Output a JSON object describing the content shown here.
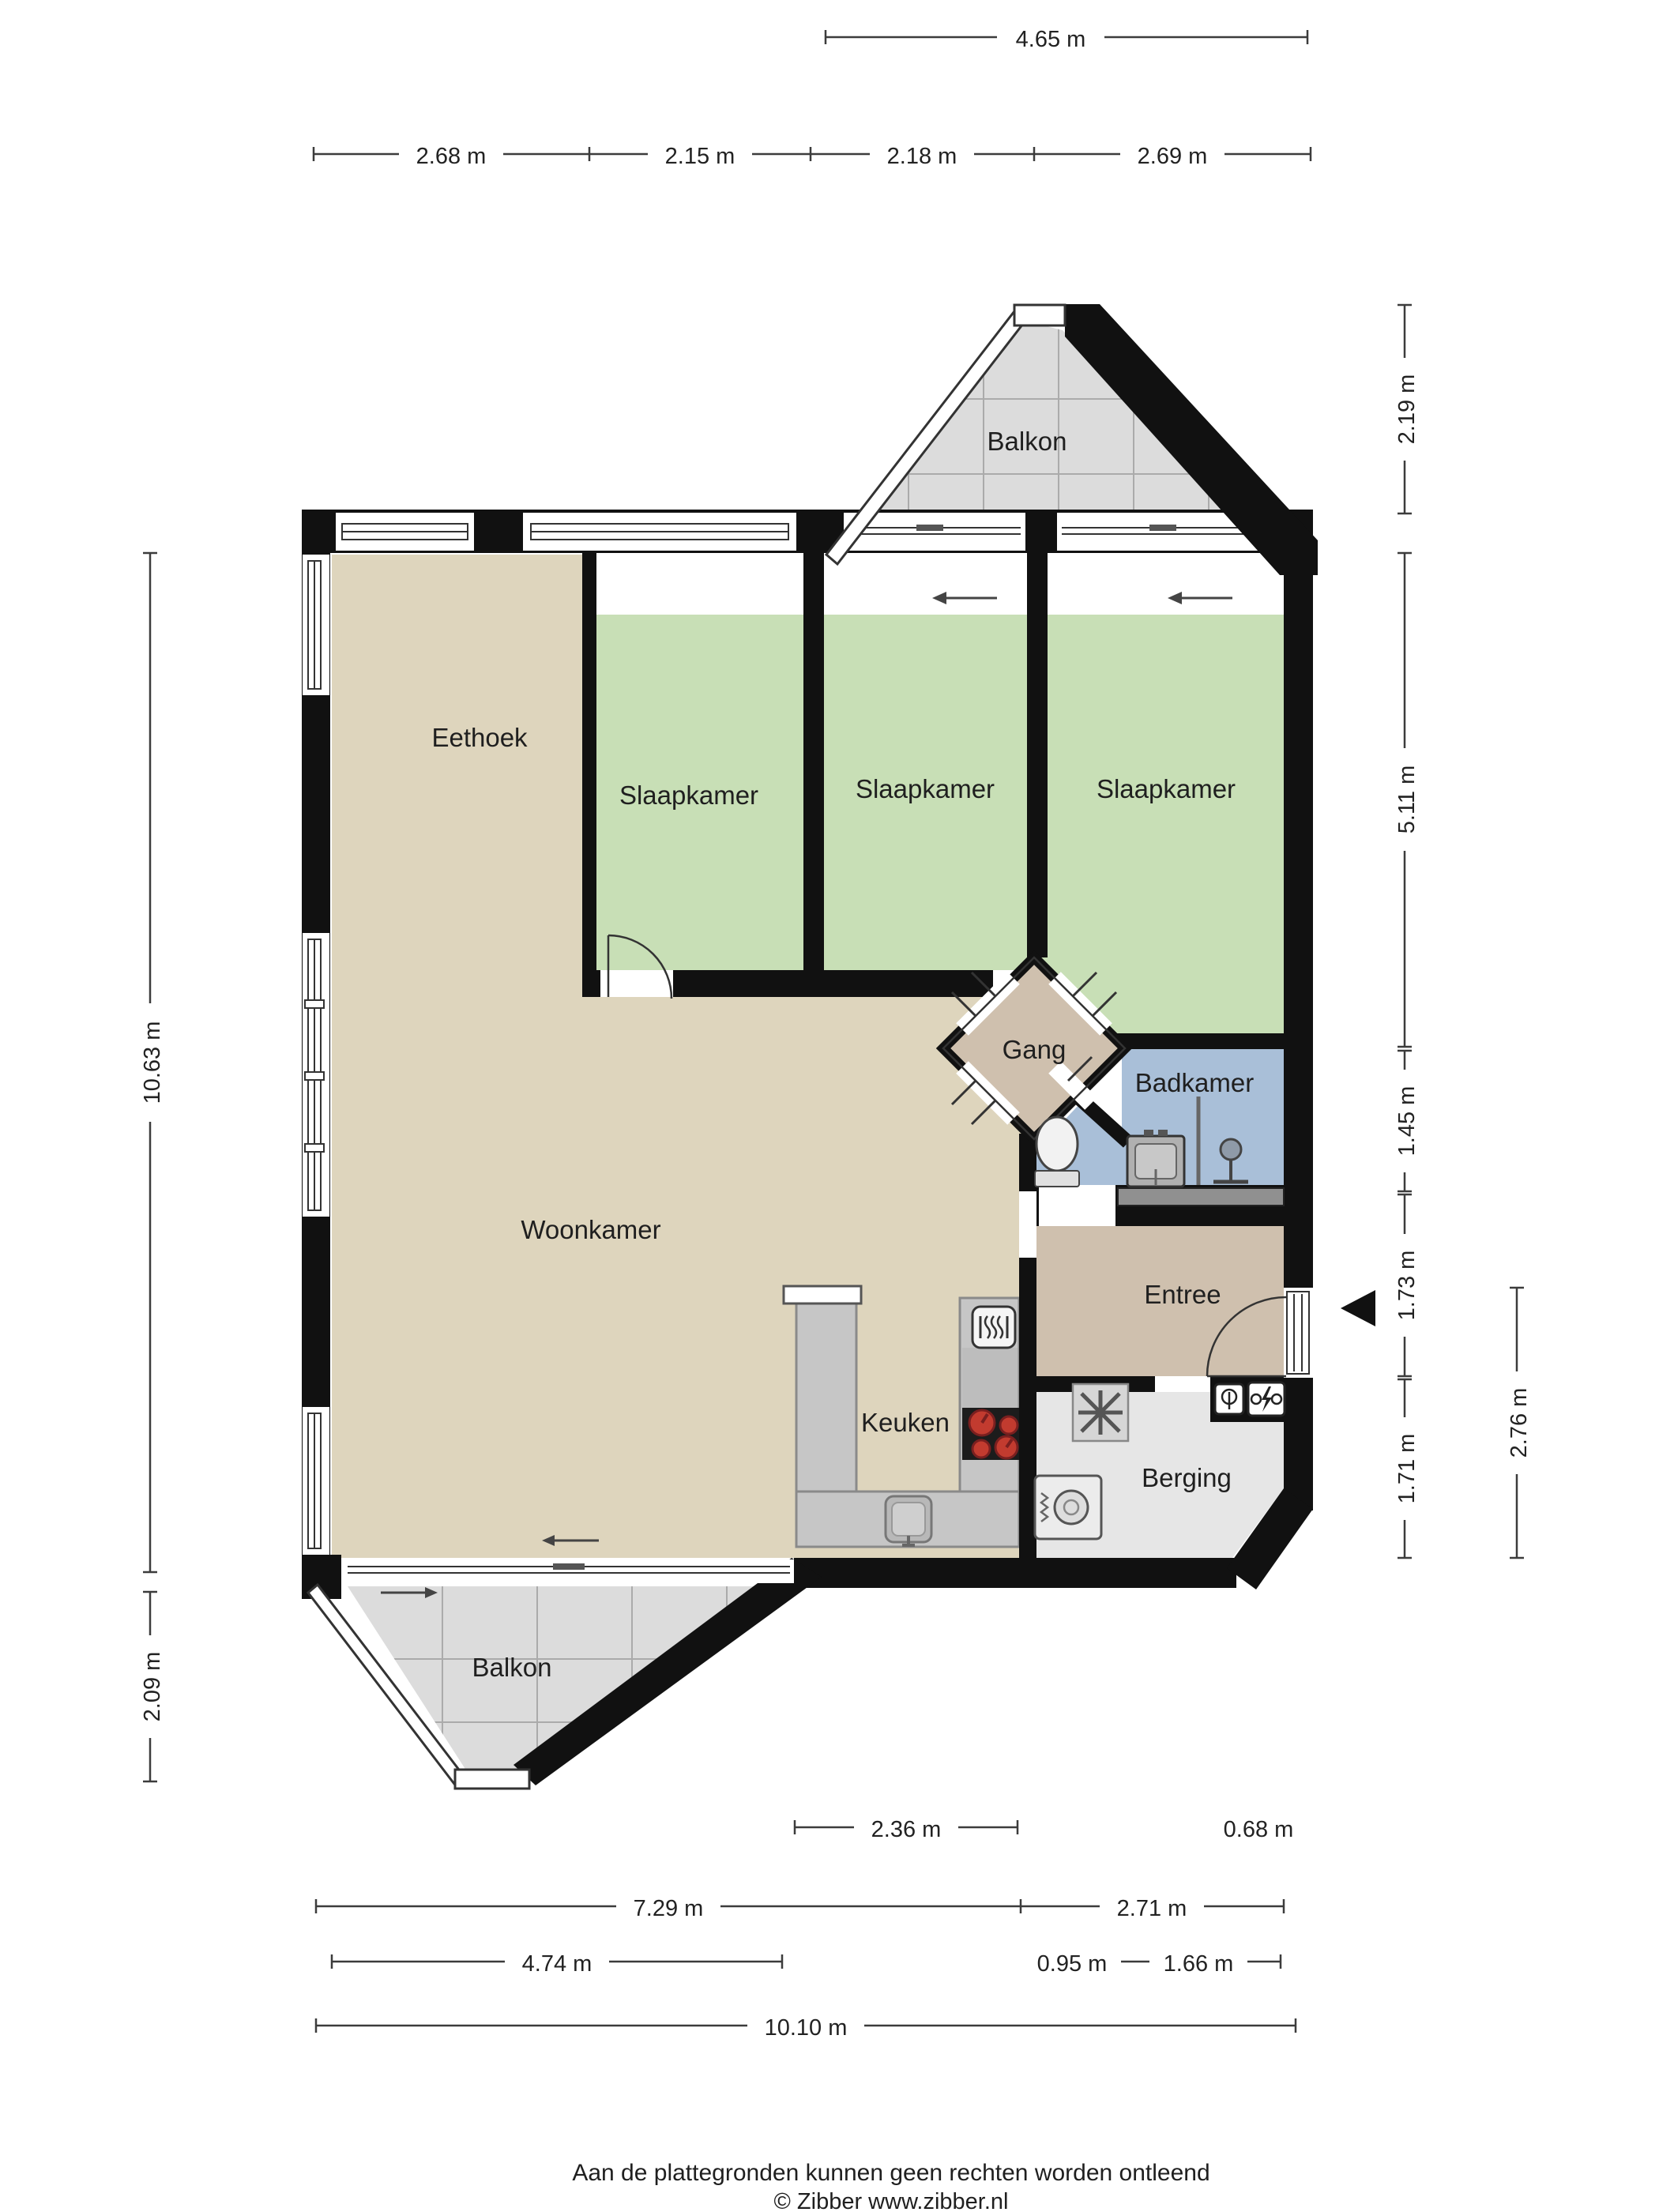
{
  "rooms": [
    {
      "id": "balkon-top",
      "label": "Balkon"
    },
    {
      "id": "eethoek",
      "label": "Eethoek"
    },
    {
      "id": "slaapkamer-1",
      "label": "Slaapkamer"
    },
    {
      "id": "slaapkamer-2",
      "label": "Slaapkamer"
    },
    {
      "id": "slaapkamer-3",
      "label": "Slaapkamer"
    },
    {
      "id": "gang",
      "label": "Gang"
    },
    {
      "id": "badkamer",
      "label": "Badkamer"
    },
    {
      "id": "woonkamer",
      "label": "Woonkamer"
    },
    {
      "id": "entree",
      "label": "Entree"
    },
    {
      "id": "keuken",
      "label": "Keuken"
    },
    {
      "id": "berging",
      "label": "Berging"
    },
    {
      "id": "balkon-bottom",
      "label": "Balkon"
    }
  ],
  "dimensions": {
    "top": "4.65 m",
    "width_segments": [
      "2.68 m",
      "2.15 m",
      "2.18 m",
      "2.69 m"
    ],
    "left_column": [
      "10.63 m",
      "2.09 m"
    ],
    "right_column": [
      "2.19 m",
      "5.11 m",
      "1.45 m",
      "1.73 m",
      "1.71 m"
    ],
    "right_outer": "2.76 m",
    "bottom_row1": [
      "2.36 m",
      "0.68 m"
    ],
    "bottom_row2": [
      "7.29 m",
      "2.71 m"
    ],
    "bottom_row3": [
      "4.74 m",
      "0.95 m",
      "1.66 m"
    ],
    "bottom_row4": "10.10 m"
  },
  "icons": {
    "entrance_marker": "left-pointing solid triangle at front door",
    "sliding_door_arrows": "thin left/right arrows on sliding doors",
    "toilet": "toilet bowl with cistern",
    "washbasin": "square basin with taps",
    "shower": "glass screen line with tap",
    "stove": "black cooktop with 4 red burners",
    "oven": "rounded square with heat waves",
    "kitchen_sink": "rounded square sink with tap",
    "washing_machine": "square with drum circle",
    "ventilation_unit": "square with asterisk rotor",
    "meter_cupboard": "boxes with lamp and electricity symbols"
  },
  "colors": {
    "wall": "#141414",
    "living": "#ded5bd",
    "bedroom": "#c8dfb6",
    "hall": "#cfc0ae",
    "bathroom": "#a9bfd8",
    "balcony_floor": "#dcdcdc",
    "storage_floor": "#e6e6e6",
    "counter": "#c6c6c6",
    "burner_red": "#c23b2f"
  },
  "footer": {
    "line1": "Aan de plattegronden kunnen geen rechten worden ontleend",
    "line2": "© Zibber www.zibber.nl"
  }
}
